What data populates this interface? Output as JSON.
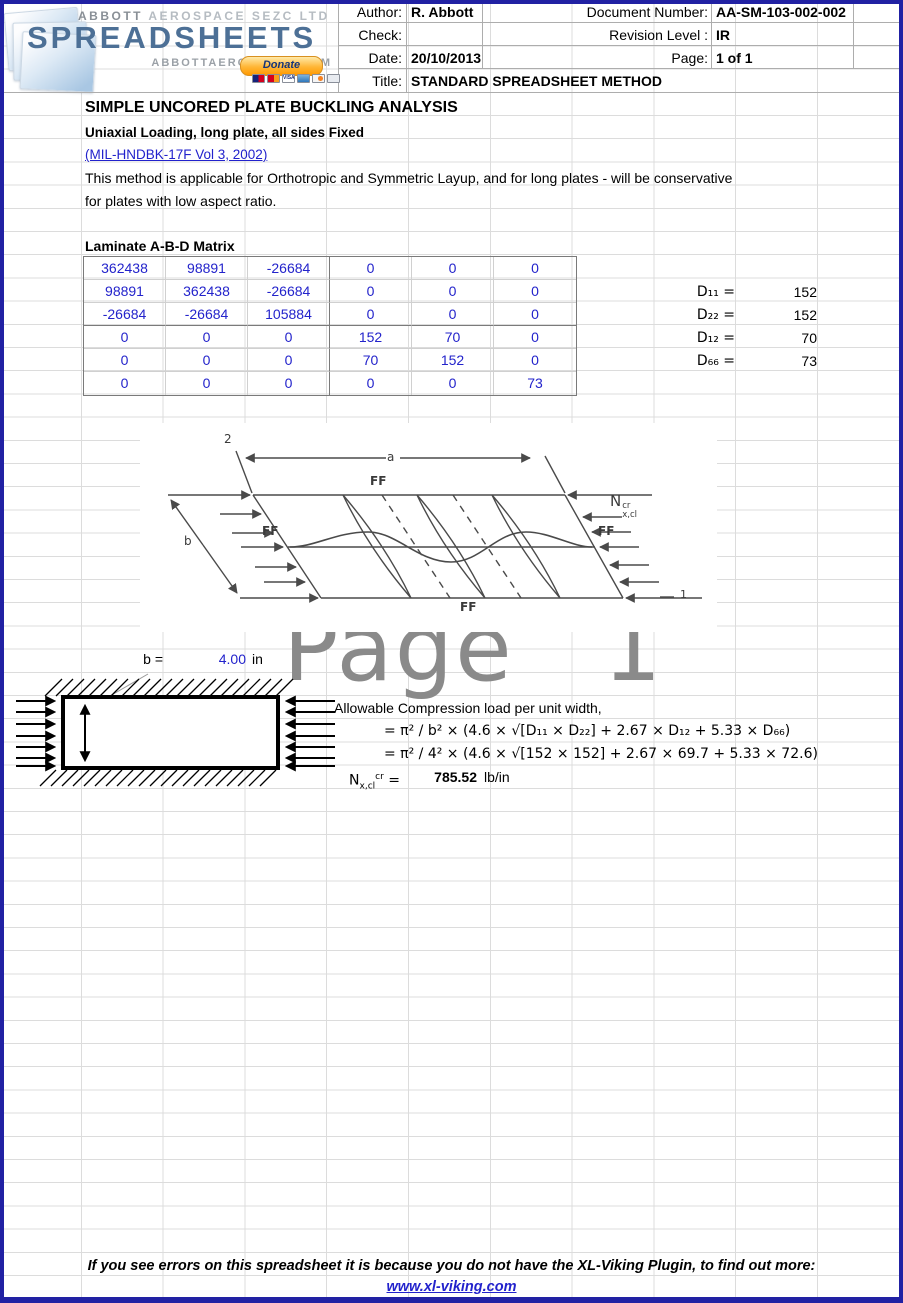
{
  "watermark": "Page 1",
  "logo": {
    "brand_top_1": "ABBOTT",
    "brand_top_2": "AEROSPACE SEZC LTD",
    "brand_main": "SPREADSHEETS",
    "brand_domain": "ABBOTTAEROSPACE.COM",
    "donate": "Donate",
    "visa": "VISA"
  },
  "header": {
    "author_label": "Author:",
    "author": "R. Abbott",
    "check_label": "Check:",
    "check": "",
    "date_label": "Date:",
    "date": "20/10/2013",
    "title_label": "Title:",
    "title": "STANDARD SPREADSHEET METHOD",
    "doc_number_label": "Document Number:",
    "doc_number": "AA-SM-103-002-002",
    "revision_label": "Revision Level :",
    "revision": "IR",
    "page_label": "Page:",
    "page": "1 of 1"
  },
  "doc": {
    "title": "SIMPLE UNCORED PLATE BUCKLING ANALYSIS",
    "subtitle": "Uniaxial Loading, long plate, all sides Fixed",
    "reference": "(MIL-HNDBK-17F Vol 3, 2002)",
    "description_1": "This method is applicable for Orthotropic and Symmetric Layup, and for long plates - will be conservative",
    "description_2": "for plates with low aspect ratio."
  },
  "matrix": {
    "title": "Laminate A-B-D Matrix",
    "rows": [
      [
        "362438",
        "98891",
        "-26684",
        "0",
        "0",
        "0"
      ],
      [
        "98891",
        "362438",
        "-26684",
        "0",
        "0",
        "0"
      ],
      [
        "-26684",
        "-26684",
        "105884",
        "0",
        "0",
        "0"
      ],
      [
        "0",
        "0",
        "0",
        "152",
        "70",
        "0"
      ],
      [
        "0",
        "0",
        "0",
        "70",
        "152",
        "0"
      ],
      [
        "0",
        "0",
        "0",
        "0",
        "0",
        "73"
      ]
    ]
  },
  "stiffness": {
    "d11_label": "D₁₁ =",
    "d11": "152",
    "d22_label": "D₂₂ =",
    "d22": "152",
    "d12_label": "D₁₂ =",
    "d12": "70",
    "d66_label": "D₆₆ =",
    "d66": "73"
  },
  "figure": {
    "axis_2": "2",
    "axis_1": "1",
    "dim_a": "a",
    "dim_b": "b",
    "ff": "FF",
    "load_base": "N",
    "load_sup": "cr",
    "load_sub": "x,cl"
  },
  "plate": {
    "b_label": "b =",
    "b_value": "4.00",
    "b_unit": "in"
  },
  "calc": {
    "intro": "Allowable Compression load per unit width,",
    "formula_symbolic": "= π² / b² × (4.6 × √[D₁₁ × D₂₂] + 2.67 × D₁₂ + 5.33 × D₆₆)",
    "formula_numeric": "= π² / 4² × (4.6 × √[152 × 152] + 2.67 × 69.7 + 5.33 × 72.6)",
    "result_base": "N",
    "result_sub": "x,cl",
    "result_sup": "cr",
    "result_eq": " =",
    "result_value": "785.52",
    "result_unit": "lb/in"
  },
  "footer": {
    "notice": "If you see errors on this spreadsheet it is because you do not have the XL-Viking Plugin, to find out more:",
    "link": "www.xl-viking.com"
  },
  "colors": {
    "input_blue": "#2222cc",
    "border_navy": "#2121a3",
    "watermark_gray": "#8a8a8a",
    "logo_blue": "#4d7096",
    "donate_orange": "#ff9900"
  }
}
